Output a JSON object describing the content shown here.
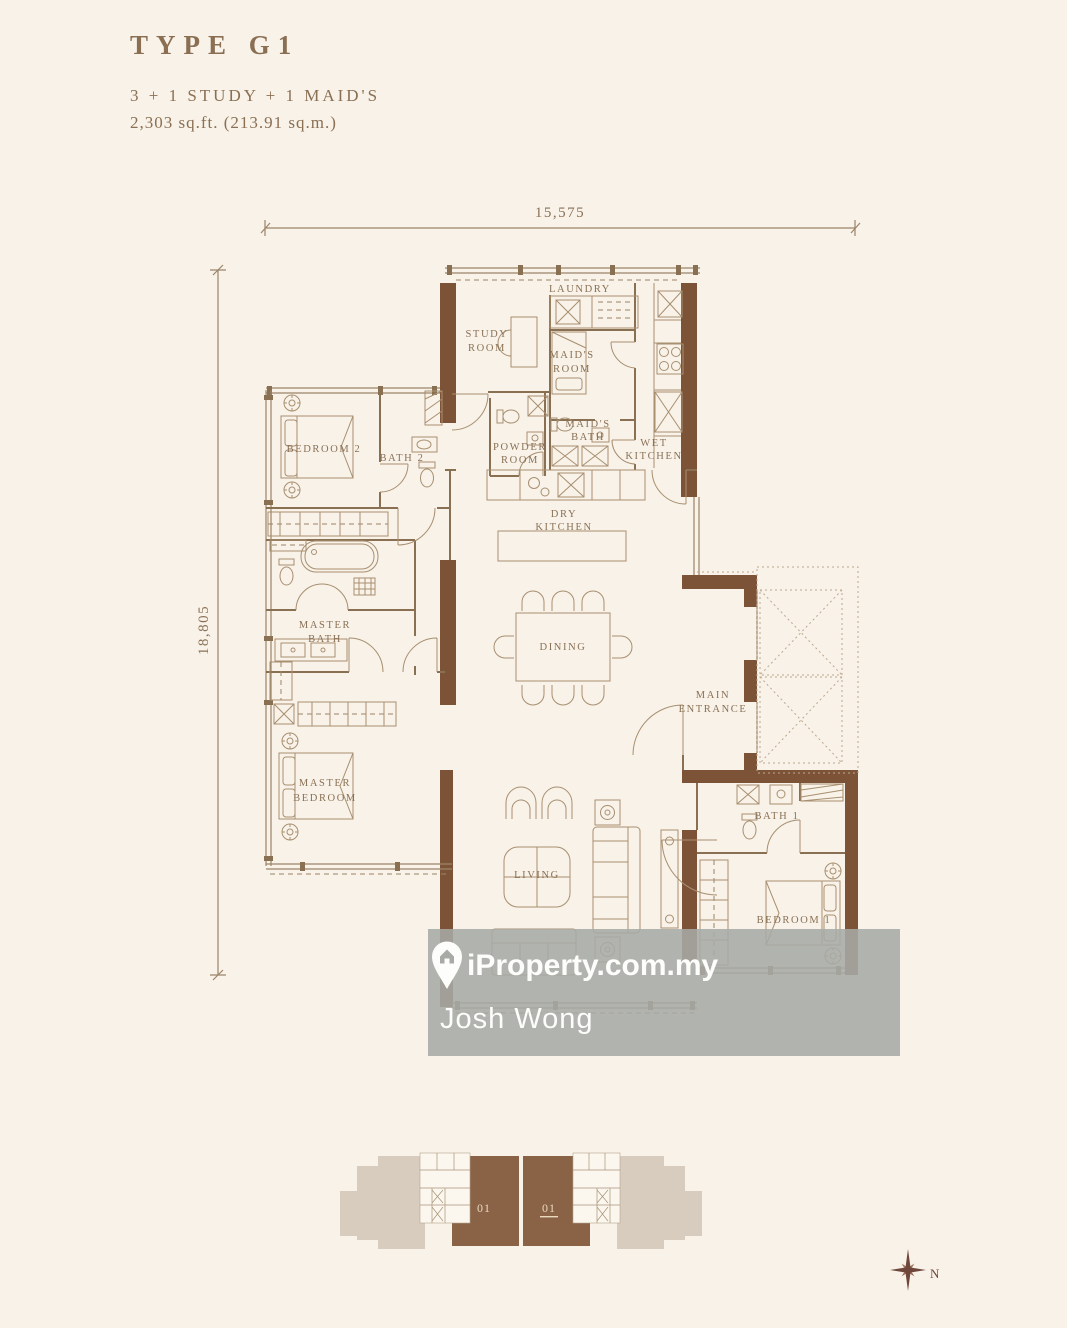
{
  "plan": {
    "type_title": "TYPE G1",
    "config": "3 + 1 STUDY + 1 MAID'S",
    "area": "2,303 sq.ft.  (213.91 sq.m.)"
  },
  "dimensions": {
    "top": "15,575",
    "left": "18,805"
  },
  "rooms": {
    "laundry": {
      "l1": "LAUNDRY"
    },
    "study": {
      "l1": "STUDY",
      "l2": "ROOM"
    },
    "maids_room": {
      "l1": "MAID'S",
      "l2": "ROOM"
    },
    "powder": {
      "l1": "POWDER",
      "l2": "ROOM"
    },
    "maids_bath": {
      "l1": "MAID'S",
      "l2": "BATH"
    },
    "wet_kitchen": {
      "l1": "WET",
      "l2": "KITCHEN"
    },
    "bedroom2": {
      "l1": "BEDROOM 2"
    },
    "bath2": {
      "l1": "BATH 2"
    },
    "dry_kitchen": {
      "l1": "DRY",
      "l2": "KITCHEN"
    },
    "dining": {
      "l1": "DINING"
    },
    "main_entrance": {
      "l1": "MAIN",
      "l2": "ENTRANCE"
    },
    "master_bath": {
      "l1": "MASTER",
      "l2": "BATH"
    },
    "master_bedroom": {
      "l1": "MASTER",
      "l2": "BEDROOM"
    },
    "living": {
      "l1": "LIVING"
    },
    "bath1": {
      "l1": "BATH 1"
    },
    "bedroom1": {
      "l1": "BEDROOM 1"
    }
  },
  "watermark": {
    "brand": "iProperty.com.my",
    "agent": "Josh Wong"
  },
  "key_plan": {
    "left_unit": "01",
    "right_unit": "01"
  },
  "compass": {
    "north_label": "N"
  },
  "colors": {
    "background": "#f8f2e8",
    "wall": "#7d5338",
    "line": "#9c8468",
    "label_text": "#8a7156",
    "title_text": "#8a6f53",
    "watermark_band": "#a7aaa5",
    "keyplan_tan": "#d8ccbf",
    "keyplan_brown": "#8a6347",
    "compass": "#6f463a"
  }
}
